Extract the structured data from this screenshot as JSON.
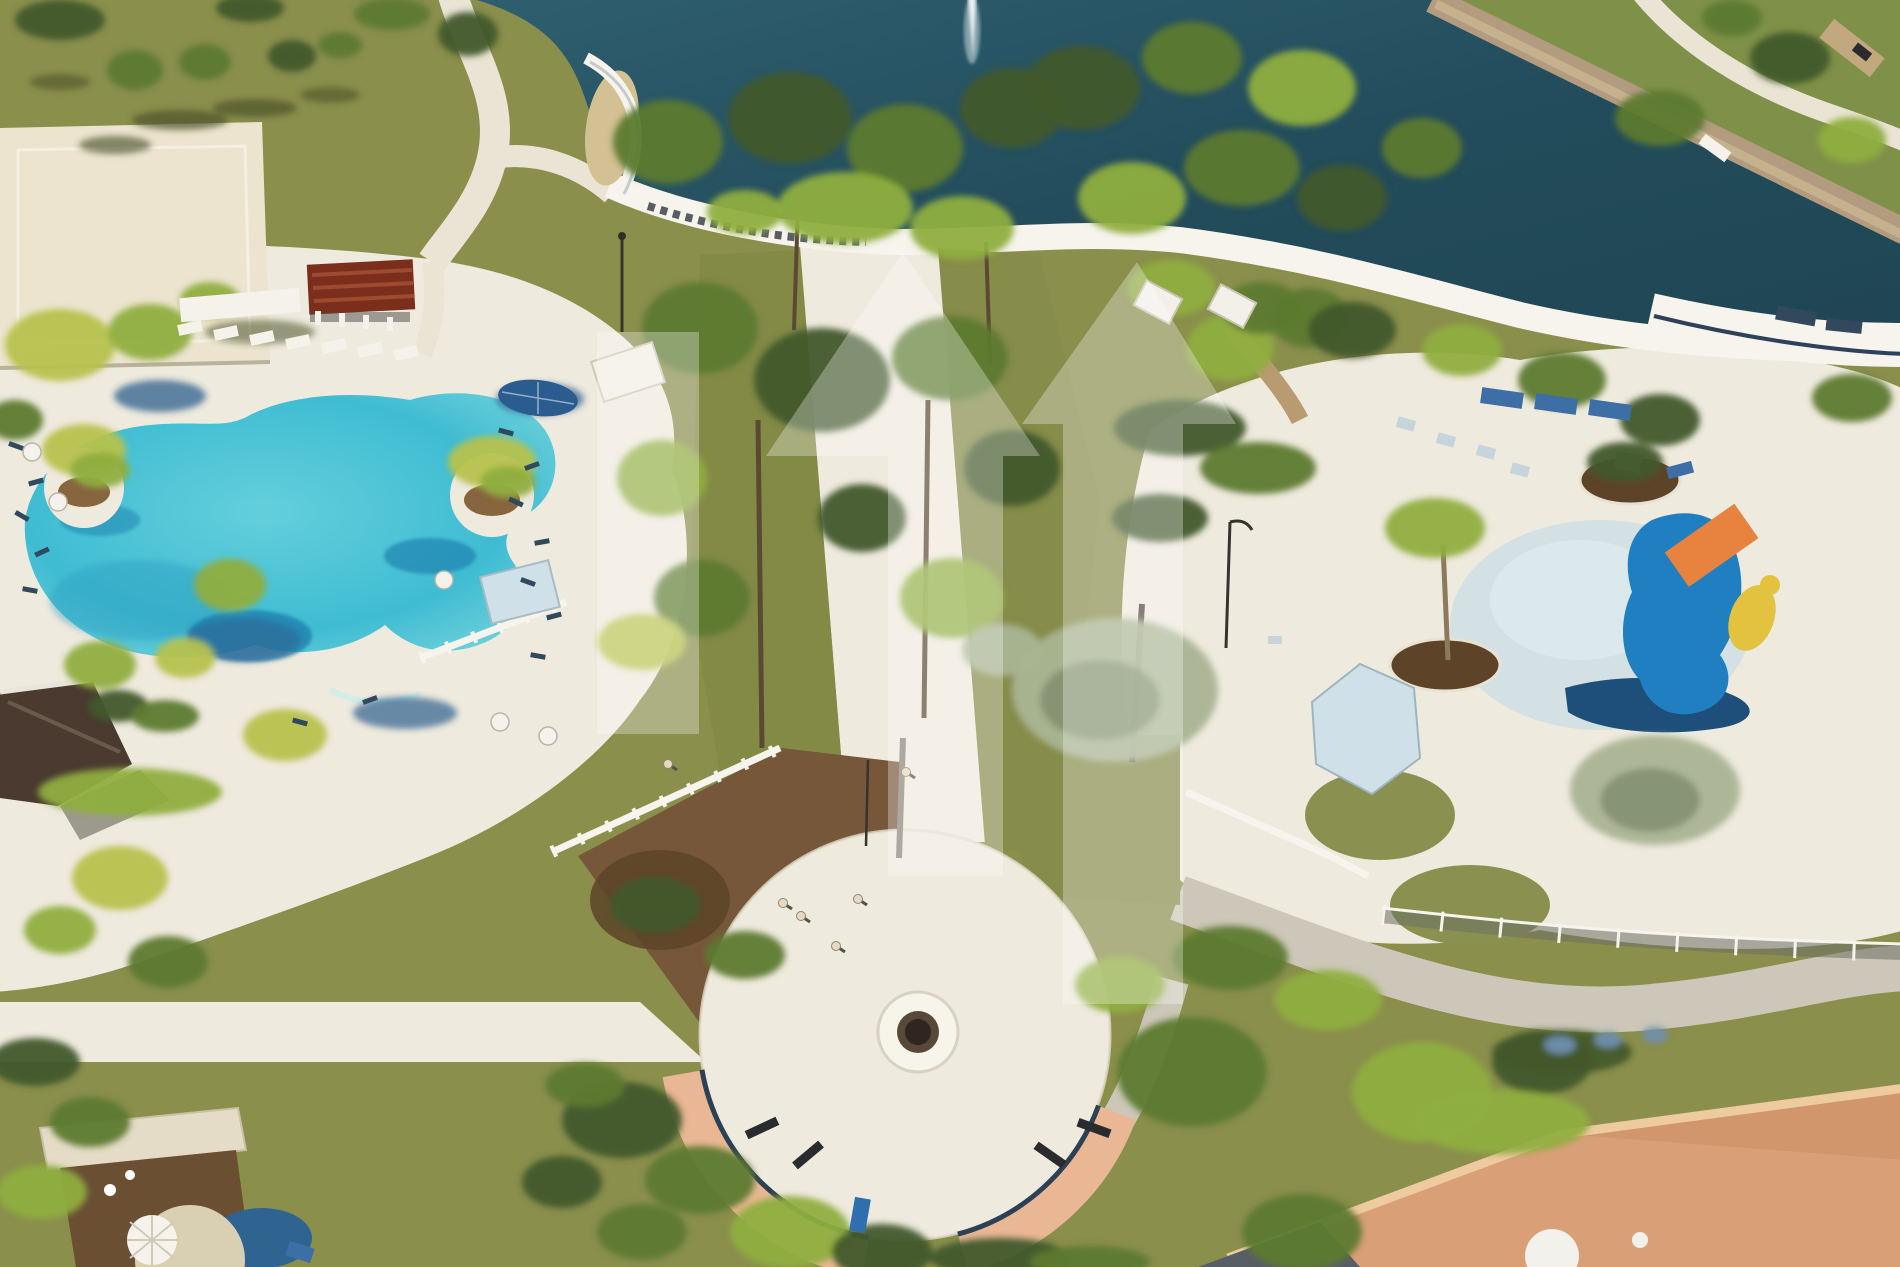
{
  "meta": {
    "kind": "aerial-photo",
    "subject": "resort community amenity center with lagoon pool, lake and splash pad",
    "width": 1900,
    "height": 1267
  },
  "palette": {
    "lawn": "#8a8f4c",
    "lawnBright": "#7f9148",
    "lakeTop": "#2f5f70",
    "lakeMid": "#234d5c",
    "lakeDeep": "#1f4553",
    "shoreTan": "#b29b7e",
    "shoreTanLight": "#cbb694",
    "deck": "#efeade",
    "path": "#e9e4d4",
    "road": "#ccc7b8",
    "court": "#ece4cf",
    "sand": "#d3c093",
    "poolEdge": "#7fd8de",
    "poolMid": "#3fbcd2",
    "poolDeepShadow": "#1f7fae",
    "mulch": "#77573a",
    "mulchDark": "#5d4428",
    "plazaSalmon": "#eab795",
    "plazaNavyEdge": "#2c4156",
    "fountainDark": "#57483a",
    "fountainCore": "#2f2620",
    "pergolaRed": "#7c2e1d",
    "roofBrown": "#4a3a30",
    "roofTerracotta": "#d9a078",
    "roofRidge": "#eeca9f",
    "roofShade": "#cf9468",
    "domeWhite": "#f2f1ec",
    "fenceWhite": "#f6f4ec",
    "balustradeDark": "#3c434b",
    "chainFence": "#6b6f64",
    "wetPatch": "#cfe0e4",
    "canopyBlue": "#cfe0e8",
    "splashBlue": "#1f7fc0",
    "splashNavy": "#1d4f7a",
    "splashOrange": "#e8833f",
    "splashYellow": "#e3c23f",
    "watermark": "#ffffff",
    "g1": "#5d7a2f",
    "g2": "#8fae3f",
    "g3": "#41582a",
    "g4": "#b6c24e",
    "g5": "#a9b494",
    "g6": "#7f8d6d",
    "g7": "#6f8fae",
    "sh": "#4b5229",
    "bs": "#2d5f8e",
    "fw": "#f4f2ea",
    "nv": "#32485c",
    "bl": "#3e6ea6",
    "lc": "#c6d4dc",
    "bw": "#c2a87e",
    "dk": "#2a2b2f",
    "bl2": "#2f6fae",
    "trunk": "#5b4a33",
    "trunkGrey": "#8a8478"
  },
  "watermark_shapes": {
    "opacity": 0.3,
    "bar": "M597,332 h102 v402 h-102 Z",
    "house_center": "M903,252 L1040,456 L1003,456 L1003,876 L888,876 L888,456 L766,456 Z",
    "house_right": "M1137,262 L1236,424 L1183,424 L1183,1004 L1063,1004 L1063,424 L1022,424 Z"
  },
  "vegetation": [
    [
      135,
      70,
      28,
      20,
      "g1"
    ],
    [
      205,
      62,
      26,
      18,
      "g1"
    ],
    [
      292,
      56,
      24,
      16,
      "g3"
    ],
    [
      60,
      20,
      45,
      20,
      "g3"
    ],
    [
      250,
      8,
      34,
      14,
      "g3"
    ],
    [
      392,
      14,
      38,
      16,
      "g1"
    ],
    [
      468,
      34,
      30,
      22,
      "g3"
    ],
    [
      340,
      45,
      22,
      13,
      "g1"
    ],
    [
      180,
      120,
      48,
      10,
      "sh",
      0.7
    ],
    [
      255,
      108,
      42,
      9,
      "sh",
      0.7
    ],
    [
      115,
      145,
      36,
      9,
      "sh",
      0.65
    ],
    [
      330,
      95,
      30,
      8,
      "sh",
      0.6
    ],
    [
      60,
      82,
      30,
      8,
      "sh",
      0.6
    ],
    [
      260,
      332,
      55,
      12,
      "sh",
      0.55
    ],
    [
      60,
      345,
      55,
      36,
      "g4"
    ],
    [
      150,
      332,
      42,
      28,
      "g2"
    ],
    [
      15,
      420,
      28,
      20,
      "g1"
    ],
    [
      210,
      300,
      30,
      18,
      "g2"
    ],
    [
      84,
      450,
      42,
      26,
      "g4"
    ],
    [
      100,
      470,
      30,
      18,
      "g2"
    ],
    [
      492,
      462,
      44,
      26,
      "g4"
    ],
    [
      508,
      482,
      28,
      16,
      "g2"
    ],
    [
      160,
      396,
      46,
      16,
      "bs",
      0.75
    ],
    [
      540,
      399,
      44,
      16,
      "bs",
      0.7
    ],
    [
      405,
      713,
      52,
      16,
      "bs",
      0.7
    ],
    [
      243,
      640,
      58,
      22,
      "bs",
      0.55
    ],
    [
      100,
      665,
      36,
      24,
      "g2"
    ],
    [
      185,
      658,
      30,
      20,
      "g4"
    ],
    [
      285,
      735,
      42,
      26,
      "g4"
    ],
    [
      130,
      792,
      92,
      24,
      "g2"
    ],
    [
      60,
      930,
      36,
      24,
      "g2"
    ],
    [
      120,
      878,
      48,
      32,
      "g4"
    ],
    [
      168,
      962,
      40,
      26,
      "g1"
    ],
    [
      35,
      1062,
      45,
      24,
      "g3"
    ],
    [
      90,
      1122,
      40,
      25,
      "g1"
    ],
    [
      42,
      1192,
      45,
      27,
      "g2"
    ],
    [
      230,
      585,
      36,
      26,
      "g2"
    ],
    [
      118,
      706,
      30,
      16,
      "g3"
    ],
    [
      165,
      716,
      34,
      16,
      "g1"
    ],
    [
      668,
      142,
      55,
      42,
      "g1"
    ],
    [
      790,
      118,
      62,
      46,
      "g3"
    ],
    [
      905,
      148,
      58,
      44,
      "g1"
    ],
    [
      1012,
      108,
      52,
      40,
      "g3"
    ],
    [
      845,
      208,
      68,
      36,
      "g2"
    ],
    [
      962,
      228,
      52,
      32,
      "g2"
    ],
    [
      745,
      212,
      38,
      22,
      "g2"
    ],
    [
      700,
      328,
      58,
      46,
      "g1"
    ],
    [
      822,
      380,
      68,
      52,
      "g3"
    ],
    [
      950,
      358,
      58,
      42,
      "g1"
    ],
    [
      662,
      478,
      45,
      38,
      "g2"
    ],
    [
      1012,
      468,
      48,
      38,
      "g3"
    ],
    [
      702,
      598,
      48,
      38,
      "g1"
    ],
    [
      952,
      598,
      52,
      40,
      "g2"
    ],
    [
      862,
      518,
      44,
      34,
      "g3"
    ],
    [
      642,
      642,
      44,
      28,
      "g4"
    ],
    [
      1002,
      650,
      40,
      26,
      "g5"
    ],
    [
      1082,
      88,
      58,
      42,
      "g3"
    ],
    [
      1192,
      58,
      50,
      36,
      "g1"
    ],
    [
      1302,
      88,
      54,
      38,
      "g2"
    ],
    [
      1242,
      168,
      58,
      38,
      "g1"
    ],
    [
      1132,
      198,
      54,
      36,
      "g2"
    ],
    [
      1342,
      198,
      45,
      33,
      "g3"
    ],
    [
      1422,
      148,
      40,
      30,
      "g1"
    ],
    [
      1230,
      348,
      44,
      33,
      "g2"
    ],
    [
      1310,
      318,
      40,
      30,
      "g1"
    ],
    [
      1180,
      428,
      66,
      28,
      "g3"
    ],
    [
      1258,
      468,
      58,
      26,
      "g1"
    ],
    [
      1160,
      518,
      48,
      24,
      "g3"
    ],
    [
      1435,
      528,
      50,
      30,
      "g2"
    ],
    [
      1625,
      462,
      38,
      20,
      "g3"
    ],
    [
      1655,
      790,
      85,
      55,
      "g5"
    ],
    [
      1115,
      690,
      103,
      72,
      "g5"
    ],
    [
      1100,
      700,
      60,
      40,
      "g6",
      0.8
    ],
    [
      1650,
      800,
      50,
      32,
      "g6",
      0.8
    ],
    [
      1230,
      958,
      58,
      32,
      "g1"
    ],
    [
      1328,
      1000,
      54,
      30,
      "g2"
    ],
    [
      1660,
      118,
      45,
      28,
      "g1"
    ],
    [
      1790,
      58,
      40,
      26,
      "g3"
    ],
    [
      1852,
      140,
      34,
      23,
      "g2"
    ],
    [
      1732,
      18,
      30,
      18,
      "g1"
    ],
    [
      1172,
      288,
      44,
      28,
      "g2"
    ],
    [
      1262,
      308,
      40,
      26,
      "g1"
    ],
    [
      1352,
      330,
      44,
      28,
      "g3"
    ],
    [
      1462,
      350,
      40,
      26,
      "g2"
    ],
    [
      1562,
      380,
      44,
      28,
      "g1"
    ],
    [
      1660,
      420,
      40,
      26,
      "g3"
    ],
    [
      1852,
      398,
      40,
      24,
      "g1"
    ],
    [
      622,
      1120,
      60,
      38,
      "g3"
    ],
    [
      700,
      1180,
      55,
      34,
      "g1"
    ],
    [
      790,
      1232,
      60,
      36,
      "g2"
    ],
    [
      642,
      1232,
      45,
      28,
      "g1"
    ],
    [
      562,
      1182,
      40,
      26,
      "g3"
    ],
    [
      882,
      1252,
      50,
      28,
      "g3"
    ],
    [
      585,
      1085,
      40,
      22,
      "g1"
    ],
    [
      1000,
      1258,
      70,
      20,
      "g3"
    ],
    [
      1090,
      1262,
      60,
      16,
      "g1"
    ],
    [
      1192,
      1072,
      75,
      55,
      "g1"
    ],
    [
      1422,
      1092,
      70,
      50,
      "g2"
    ],
    [
      1542,
      1062,
      50,
      32,
      "g3"
    ],
    [
      1302,
      1232,
      60,
      38,
      "g1"
    ],
    [
      1502,
      1122,
      88,
      32,
      "g2"
    ],
    [
      1562,
      1052,
      70,
      22,
      "g3",
      0.9
    ],
    [
      1120,
      985,
      45,
      28,
      "g2"
    ],
    [
      1560,
      1045,
      16,
      9,
      "g7"
    ],
    [
      1608,
      1040,
      14,
      8,
      "g7"
    ],
    [
      1655,
      1035,
      13,
      8,
      "g7"
    ],
    [
      655,
      905,
      45,
      28,
      "g3"
    ],
    [
      745,
      955,
      40,
      24,
      "g1"
    ]
  ],
  "furniture": [
    [
      190,
      328,
      24,
      11,
      -12,
      "fw"
    ],
    [
      226,
      333,
      24,
      11,
      -12,
      "fw"
    ],
    [
      262,
      338,
      24,
      11,
      -12,
      "fw"
    ],
    [
      298,
      342,
      24,
      11,
      -12,
      "fw"
    ],
    [
      334,
      346,
      24,
      11,
      -12,
      "fw"
    ],
    [
      370,
      350,
      24,
      11,
      -12,
      "fw"
    ],
    [
      406,
      353,
      24,
      11,
      -12,
      "fw"
    ],
    [
      240,
      305,
      120,
      24,
      -5,
      "fw"
    ],
    [
      16,
      446,
      15,
      5,
      20,
      "nv"
    ],
    [
      36,
      482,
      15,
      5,
      -15,
      "nv"
    ],
    [
      22,
      516,
      15,
      5,
      30,
      "nv"
    ],
    [
      42,
      552,
      15,
      5,
      -25,
      "nv"
    ],
    [
      30,
      590,
      15,
      5,
      10,
      "nv"
    ],
    [
      506,
      432,
      15,
      5,
      15,
      "nv"
    ],
    [
      532,
      466,
      15,
      5,
      -20,
      "nv"
    ],
    [
      516,
      502,
      15,
      5,
      25,
      "nv"
    ],
    [
      542,
      542,
      15,
      5,
      -10,
      "nv"
    ],
    [
      528,
      582,
      15,
      5,
      20,
      "nv"
    ],
    [
      554,
      616,
      15,
      5,
      -15,
      "nv"
    ],
    [
      538,
      656,
      15,
      5,
      10,
      "nv"
    ],
    [
      370,
      700,
      15,
      5,
      -20,
      "nv"
    ],
    [
      300,
      722,
      15,
      5,
      15,
      "nv"
    ],
    [
      1502,
      398,
      42,
      16,
      8,
      "bl"
    ],
    [
      1556,
      404,
      42,
      16,
      8,
      "bl"
    ],
    [
      1610,
      410,
      42,
      16,
      8,
      "bl"
    ],
    [
      1406,
      424,
      18,
      11,
      15,
      "lc"
    ],
    [
      1446,
      440,
      18,
      11,
      15,
      "lc"
    ],
    [
      1486,
      452,
      18,
      11,
      15,
      "lc"
    ],
    [
      1520,
      470,
      18,
      11,
      15,
      "lc"
    ],
    [
      1275,
      640,
      14,
      8,
      0,
      "lc"
    ],
    [
      1715,
      148,
      32,
      12,
      36,
      "fw"
    ],
    [
      1852,
      48,
      64,
      24,
      38,
      "bw"
    ],
    [
      1862,
      52,
      18,
      10,
      38,
      "dk"
    ],
    [
      318,
      318,
      6,
      14,
      0,
      "fw"
    ],
    [
      342,
      320,
      6,
      14,
      0,
      "fw"
    ],
    [
      366,
      322,
      6,
      14,
      0,
      "fw"
    ],
    [
      390,
      324,
      6,
      14,
      0,
      "fw"
    ],
    [
      762,
      1128,
      34,
      9,
      -25,
      "dk"
    ],
    [
      808,
      1155,
      34,
      9,
      -40,
      "dk"
    ],
    [
      1050,
      1155,
      34,
      9,
      35,
      "dk"
    ],
    [
      1094,
      1128,
      34,
      9,
      20,
      "dk"
    ],
    [
      860,
      1215,
      16,
      34,
      10,
      "bl2"
    ],
    [
      1796,
      316,
      40,
      14,
      10,
      "nv"
    ],
    [
      1844,
      326,
      36,
      12,
      6,
      "nv"
    ],
    [
      1680,
      470,
      26,
      12,
      -15,
      "bl"
    ],
    [
      300,
      1252,
      26,
      15,
      18,
      "bl"
    ]
  ],
  "tables": [
    [
      32,
      452
    ],
    [
      58,
      502
    ],
    [
      500,
      722
    ],
    [
      548,
      736
    ],
    [
      444,
      580
    ]
  ],
  "people": [
    [
      783,
      903
    ],
    [
      801,
      916
    ],
    [
      836,
      946
    ],
    [
      858,
      899
    ],
    [
      668,
      764
    ],
    [
      906,
      772
    ]
  ]
}
